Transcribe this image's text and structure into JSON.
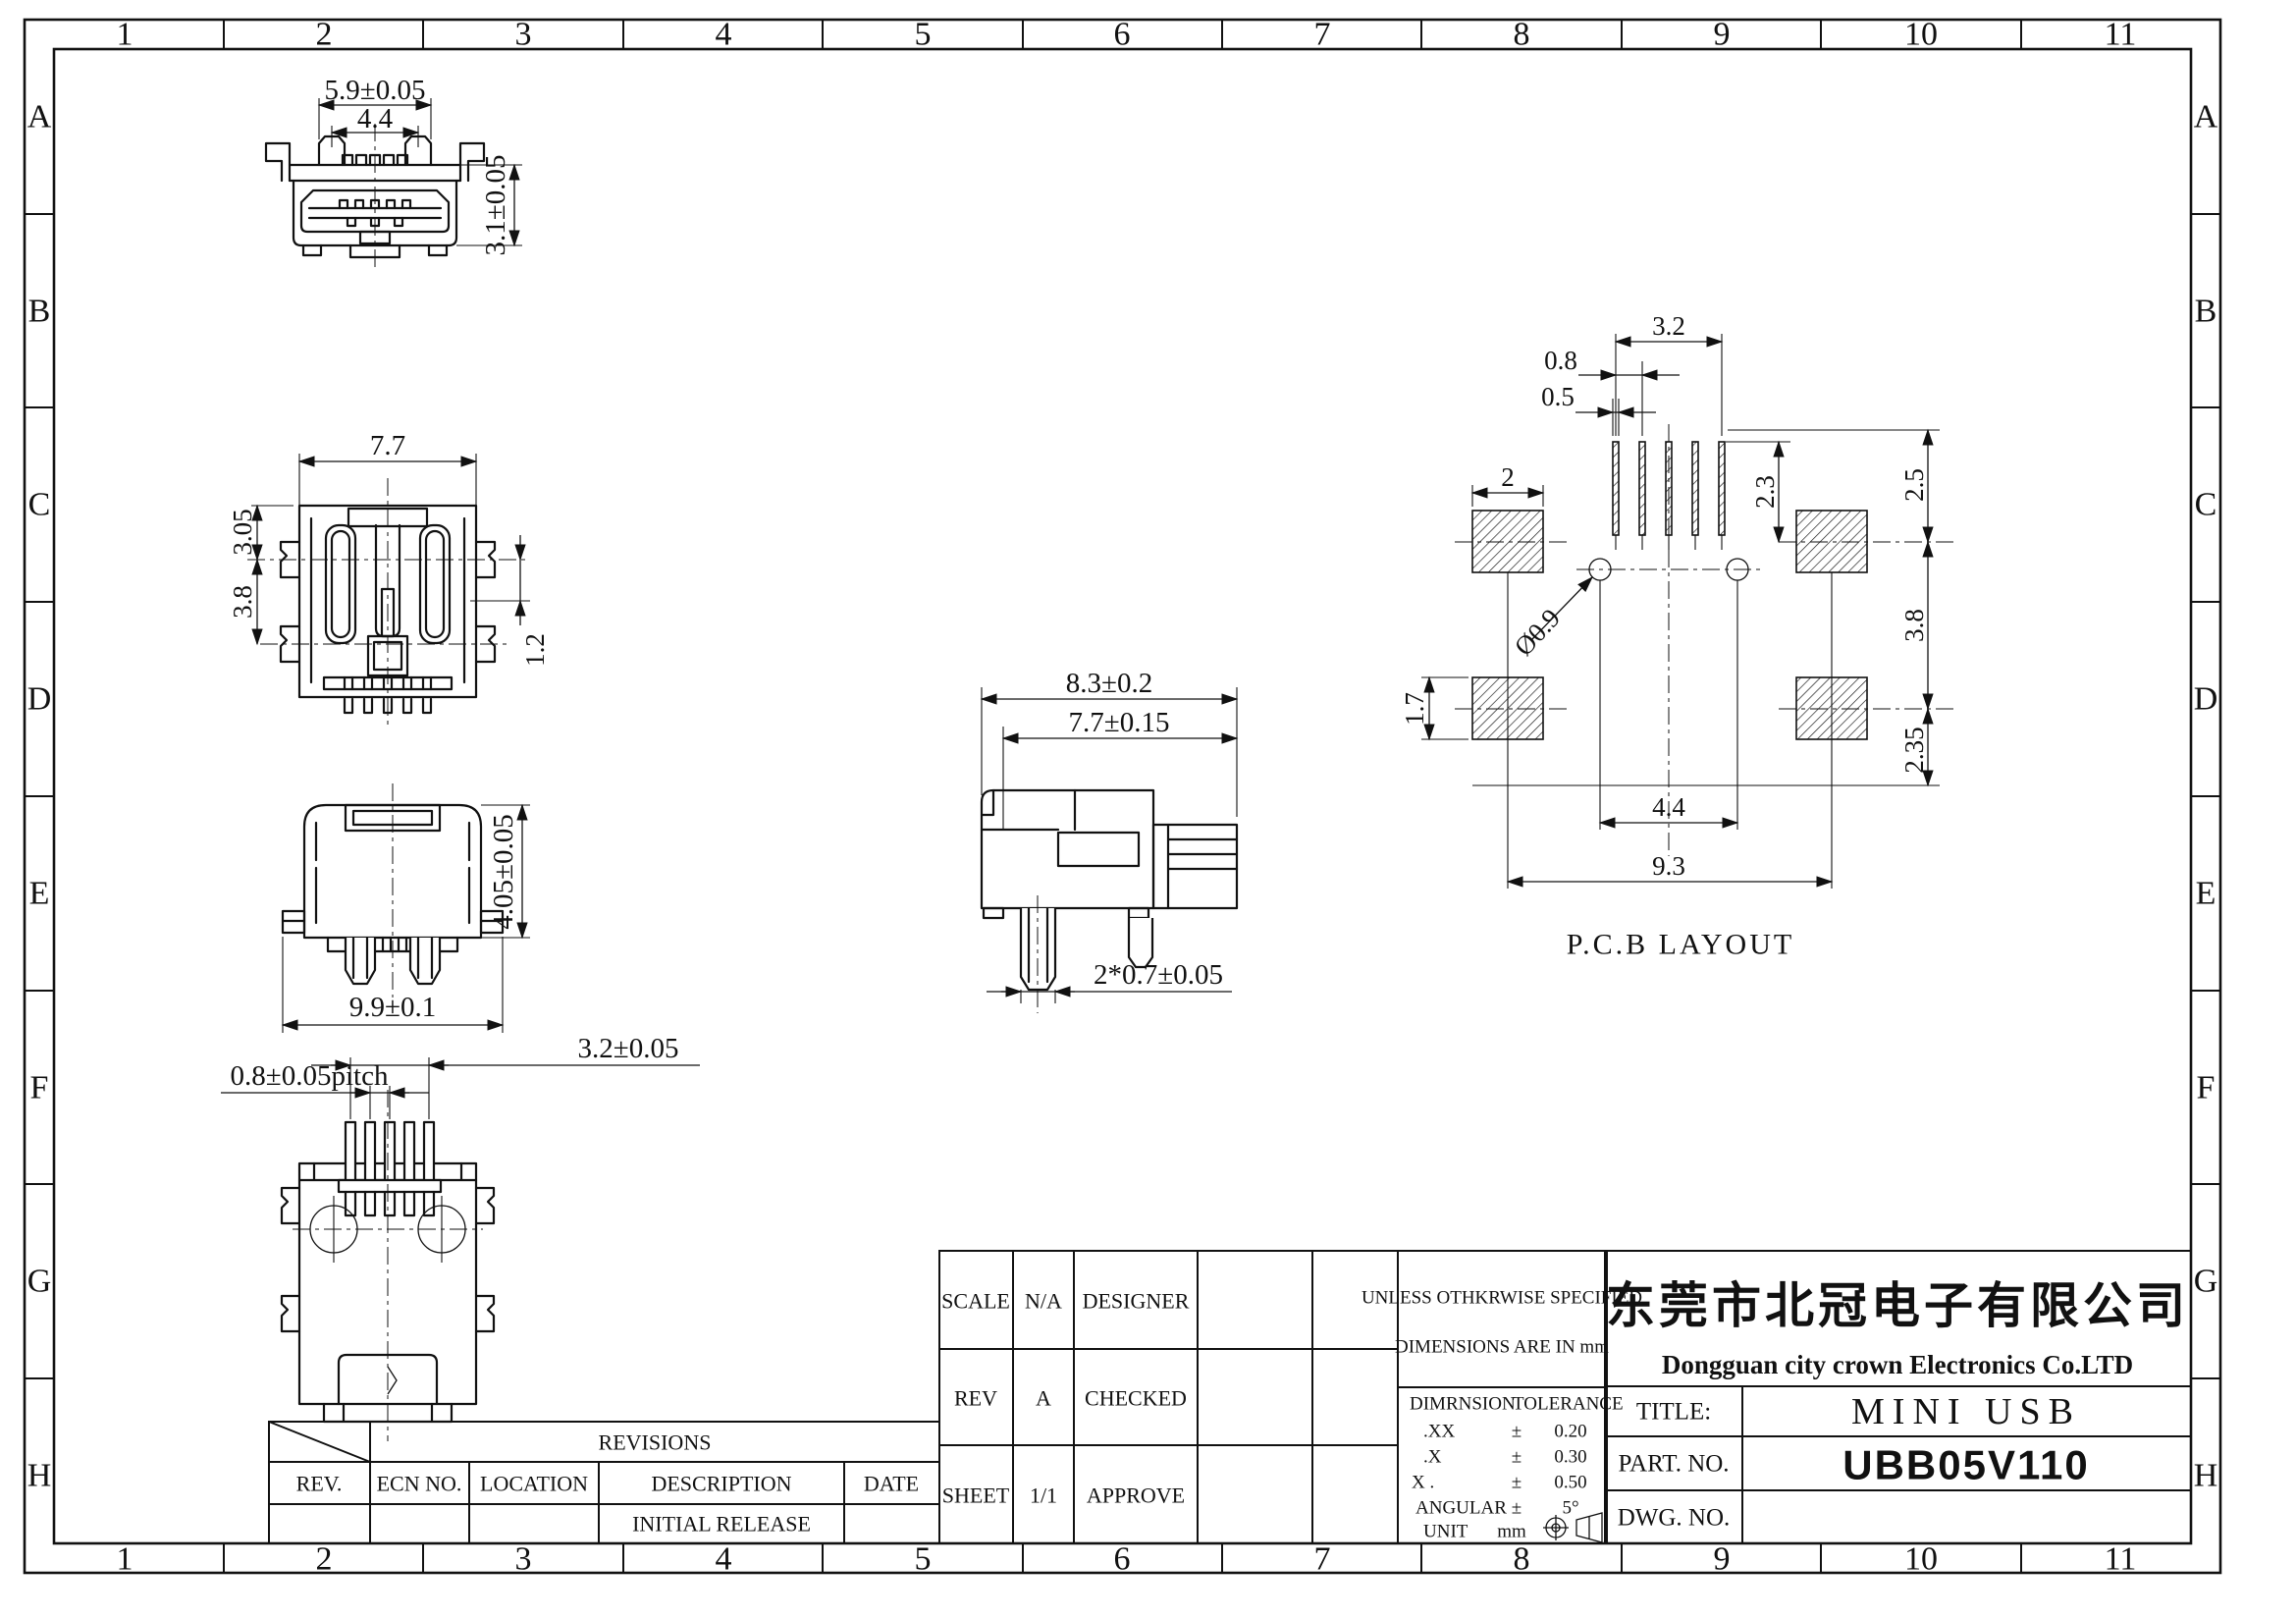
{
  "colors": {
    "ink": "#111111",
    "paper": "#ffffff"
  },
  "zones": {
    "cols": [
      "1",
      "2",
      "3",
      "4",
      "5",
      "6",
      "7",
      "8",
      "9",
      "10",
      "11"
    ],
    "rows": [
      "A",
      "B",
      "C",
      "D",
      "E",
      "F",
      "G",
      "H"
    ]
  },
  "views": {
    "front": {
      "dim_width": "5.9±0.05",
      "dim_inner_width": "4.4",
      "dim_height": "3.1±0.05"
    },
    "top": {
      "dim_width": "7.7",
      "dim_upper": "3.05",
      "dim_lower": "3.8",
      "dim_right": "1.2"
    },
    "back": {
      "dim_width": "9.9±0.1",
      "dim_height": "4.05±0.05"
    },
    "bottom": {
      "dim_span": "3.2±0.05",
      "dim_pitch": "0.8±0.05pitch"
    },
    "side": {
      "dim_depth": "8.3±0.2",
      "dim_inner_depth": "7.7±0.15",
      "dim_legs": "2*0.7±0.05"
    },
    "pcb": {
      "label": "P.C.B LAYOUT",
      "dim_span": "3.2",
      "dim_pitch": "0.8",
      "dim_slot": "0.5",
      "dim_pad_w": "2",
      "dim_slot_h": "2.3",
      "dim_top_gap": "2.5",
      "dim_rows": "3.8",
      "dim_pad_h": "1.7",
      "dim_bottom": "2.35",
      "dim_holes": "4.4",
      "dim_pads": "9.3",
      "dim_hole_d": "Ø0.9"
    }
  },
  "revisions": {
    "title": "REVISIONS",
    "col_rev": "REV.",
    "col_ecn": "ECN NO.",
    "col_loc": "LOCATION",
    "col_desc": "DESCRIPTION",
    "col_date": "DATE",
    "row1_desc": "INITIAL RELEASE"
  },
  "info": {
    "scale_label": "SCALE",
    "scale_value": "N/A",
    "designer_label": "DESIGNER",
    "rev_label": "REV",
    "rev_value": "A",
    "checked_label": "CHECKED",
    "sheet_label": "SHEET",
    "sheet_value": "1/1",
    "approve_label": "APPROVE"
  },
  "tolerance": {
    "note1": "UNLESS OTHKRWISE SPECIFIED",
    "note2": "DIMENSIONS ARE IN mm",
    "h_dim": "DIMRNSION",
    "h_tol": "TOLERANCE",
    "r1_d": ".XX",
    "r1_s": "±",
    "r1_v": "0.20",
    "r2_d": ".X",
    "r2_s": "±",
    "r2_v": "0.30",
    "r3_d": "X .",
    "r3_s": "±",
    "r3_v": "0.50",
    "r4_d": "ANGULAR",
    "r4_s": "±",
    "r4_v": "5°",
    "r5_d": "UNIT",
    "r5_v": "mm"
  },
  "title_block": {
    "company_cn": "东莞市北冠电子有限公司",
    "company_en": "Dongguan city crown Electronics Co.LTD",
    "title_label": "TITLE:",
    "title_value": "MINI USB",
    "part_label": "PART. NO.",
    "part_value": "UBB05V110",
    "dwg_label": "DWG. NO.",
    "dwg_value": ""
  }
}
